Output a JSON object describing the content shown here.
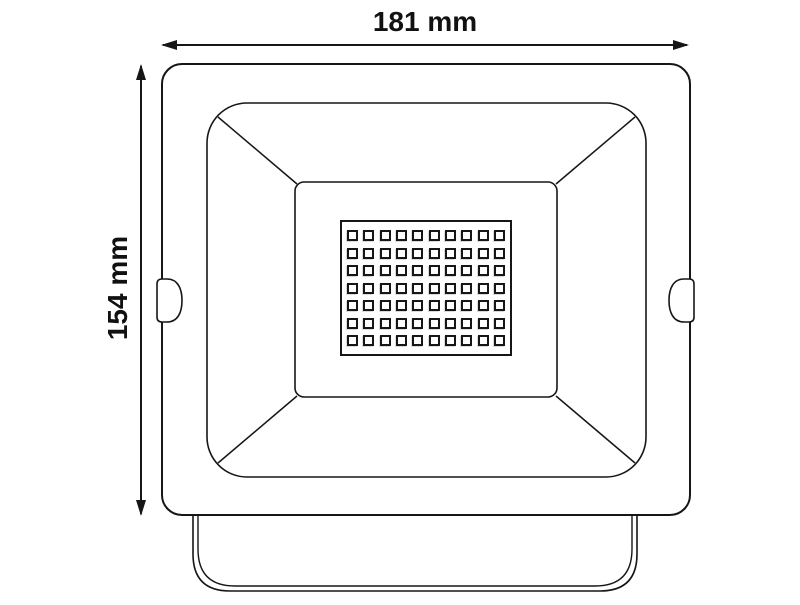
{
  "figure": {
    "title": "floodlight-dimension-diagram",
    "line_color": "#161616",
    "background_color": "#ffffff"
  },
  "dimensions": {
    "width_label": "181 mm",
    "height_label": "154 mm"
  },
  "led_grid": {
    "rows": 7,
    "columns": 10,
    "cell_px": 11
  }
}
